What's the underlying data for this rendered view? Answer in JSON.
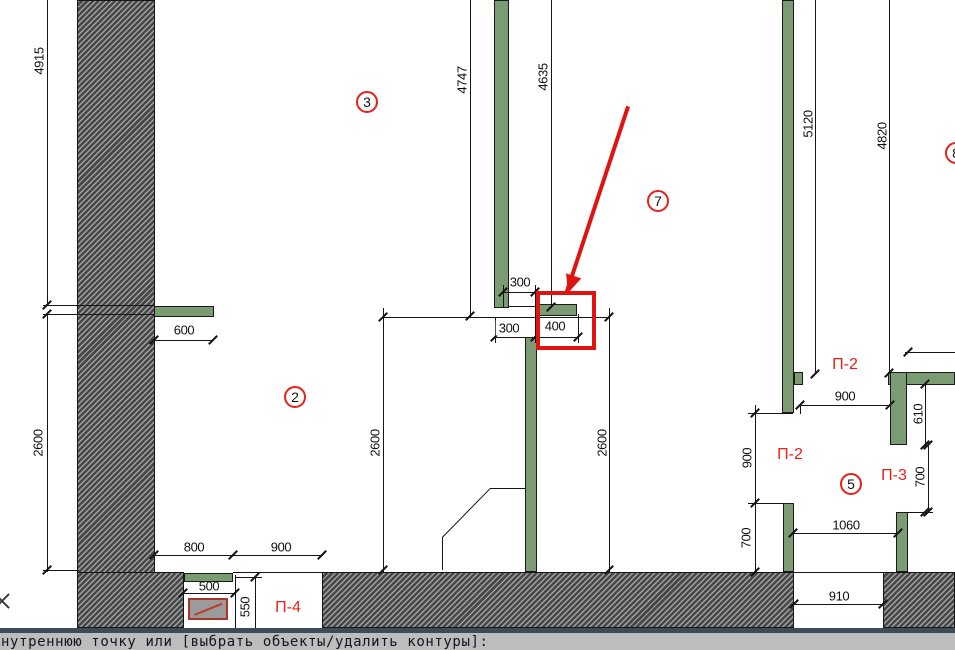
{
  "app": {
    "type": "cad-floor-plan-editor",
    "view": "plan-drawing"
  },
  "dims": {
    "d4915": "4915",
    "d2600_left": "2600",
    "d600": "600",
    "d4747": "4747",
    "d4635": "4635",
    "d300_top": "300",
    "d300": "300",
    "d400": "400",
    "d2600_room2": "2600",
    "d2600_room7": "2600",
    "d5120": "5120",
    "d4820": "4820",
    "d900_top": "900",
    "d610": "610",
    "d700_right": "700",
    "d900_left": "900",
    "d700_left": "700",
    "d1060": "1060",
    "d910": "910",
    "d800": "800",
    "d900_bottom": "900",
    "d500": "500",
    "d550": "550"
  },
  "rooms": {
    "r2": "2",
    "r3": "3",
    "r5": "5",
    "r7": "7",
    "r8": "8"
  },
  "panels": {
    "p2_top": "П-2",
    "p2_left": "П-2",
    "p3": "П-3",
    "p4": "П-4"
  },
  "command_line": {
    "prompt": "нутреннюю точку или [выбрать объекты/удалить контуры]:"
  },
  "colors": {
    "wall_green": "#7B9B73",
    "annotation_red": "#DF1410",
    "label_red": "#E8201A",
    "hatch_dark": "#474747",
    "hatch_light": "#A2A2A2",
    "window_border": "#A8352A",
    "window_fill": "#9B9B9B",
    "cmd_bg": "#BDBDBD",
    "cmd_border": "#3D4A57"
  }
}
